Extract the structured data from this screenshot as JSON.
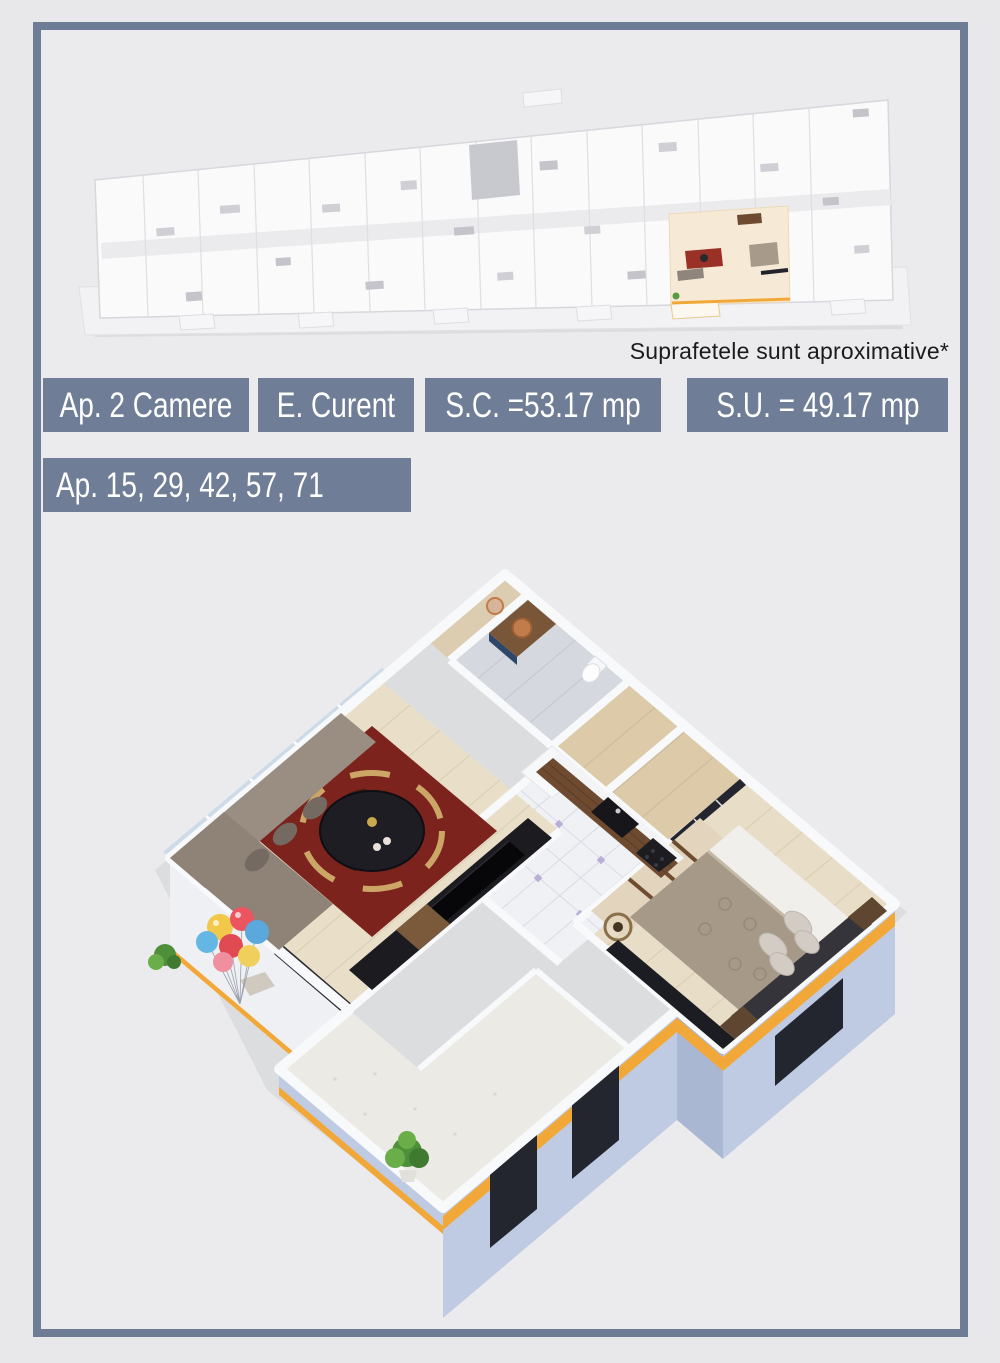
{
  "header": {
    "disclaimer": "Suprafetele sunt aproximative*"
  },
  "labels": {
    "apartment_type": "Ap. 2 Camere",
    "stage": "E. Curent",
    "built_area": "S.C. =53.17 mp",
    "usable_area": "S.U. = 49.17 mp",
    "apartment_numbers": "Ap. 15, 29, 42, 57, 71"
  },
  "colors": {
    "page-bg": "#e8e8ea",
    "frame-bg": "#ebebed",
    "frame-border": "#6f7c95",
    "bar-bg": "#6f7d96",
    "bar-text": "#ffffff",
    "note-text": "#1b1b1d",
    "accent-orange": "#f2a838",
    "exterior-blue": "#bfcbe3"
  }
}
